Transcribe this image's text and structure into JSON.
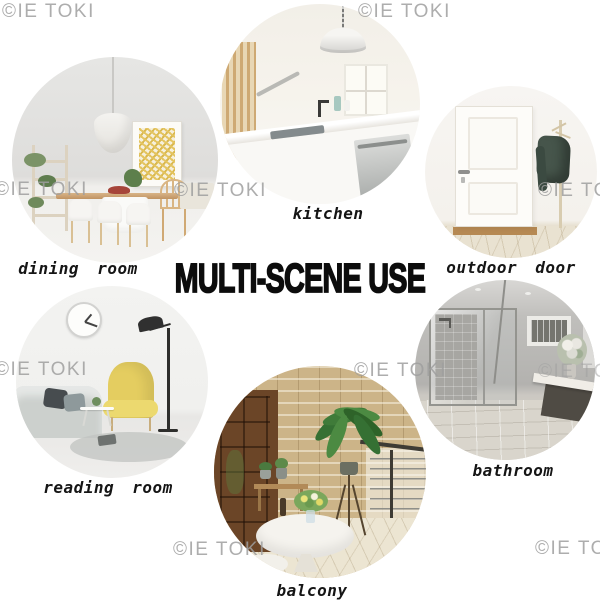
{
  "title": "MULTI-SCENE USE",
  "watermark": "©IE TOKI",
  "scenes": [
    {
      "id": "dining-room",
      "label": "dining room"
    },
    {
      "id": "kitchen",
      "label": "kitchen"
    },
    {
      "id": "outdoor-door",
      "label": "outdoor door"
    },
    {
      "id": "reading-room",
      "label": "reading room"
    },
    {
      "id": "bathroom",
      "label": "bathroom"
    },
    {
      "id": "balcony",
      "label": "balcony"
    }
  ],
  "colors": {
    "background": "#ffffff",
    "title_text": "#0c0c0c",
    "label_text": "#151515",
    "watermark_text": "#9f9f9f"
  }
}
